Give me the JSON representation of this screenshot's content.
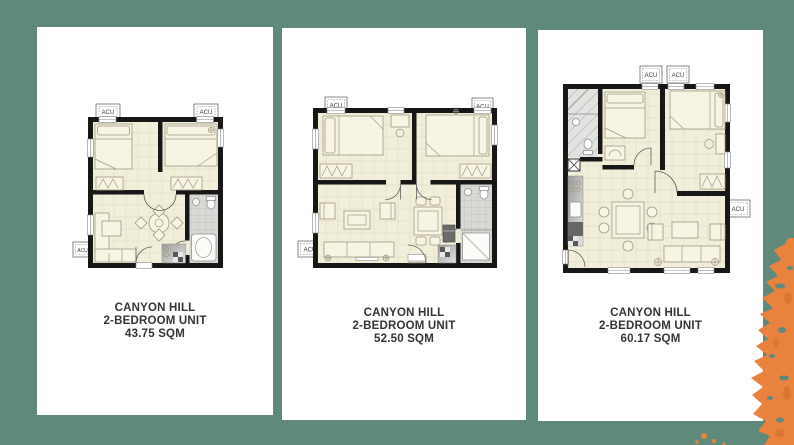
{
  "page": {
    "background_color": "#5f8a7b",
    "splash_color": "#e8823e",
    "card_color": "#ffffff"
  },
  "cards": [
    {
      "title": "CANYON HILL",
      "subtitle": "2-BEDROOM UNIT",
      "area": "43.75 SQM",
      "acu_labels": [
        "ACU",
        "ACU",
        "ACU"
      ]
    },
    {
      "title": "CANYON HILL",
      "subtitle": "2-BEDROOM UNIT",
      "area": "52.50 SQM",
      "acu_labels": [
        "ACU",
        "ACU",
        "ACU"
      ]
    },
    {
      "title": "CANYON HILL",
      "subtitle": "2-BEDROOM UNIT",
      "area": "60.17 SQM",
      "acu_labels": [
        "ACU",
        "ACU",
        "ACU"
      ]
    }
  ]
}
